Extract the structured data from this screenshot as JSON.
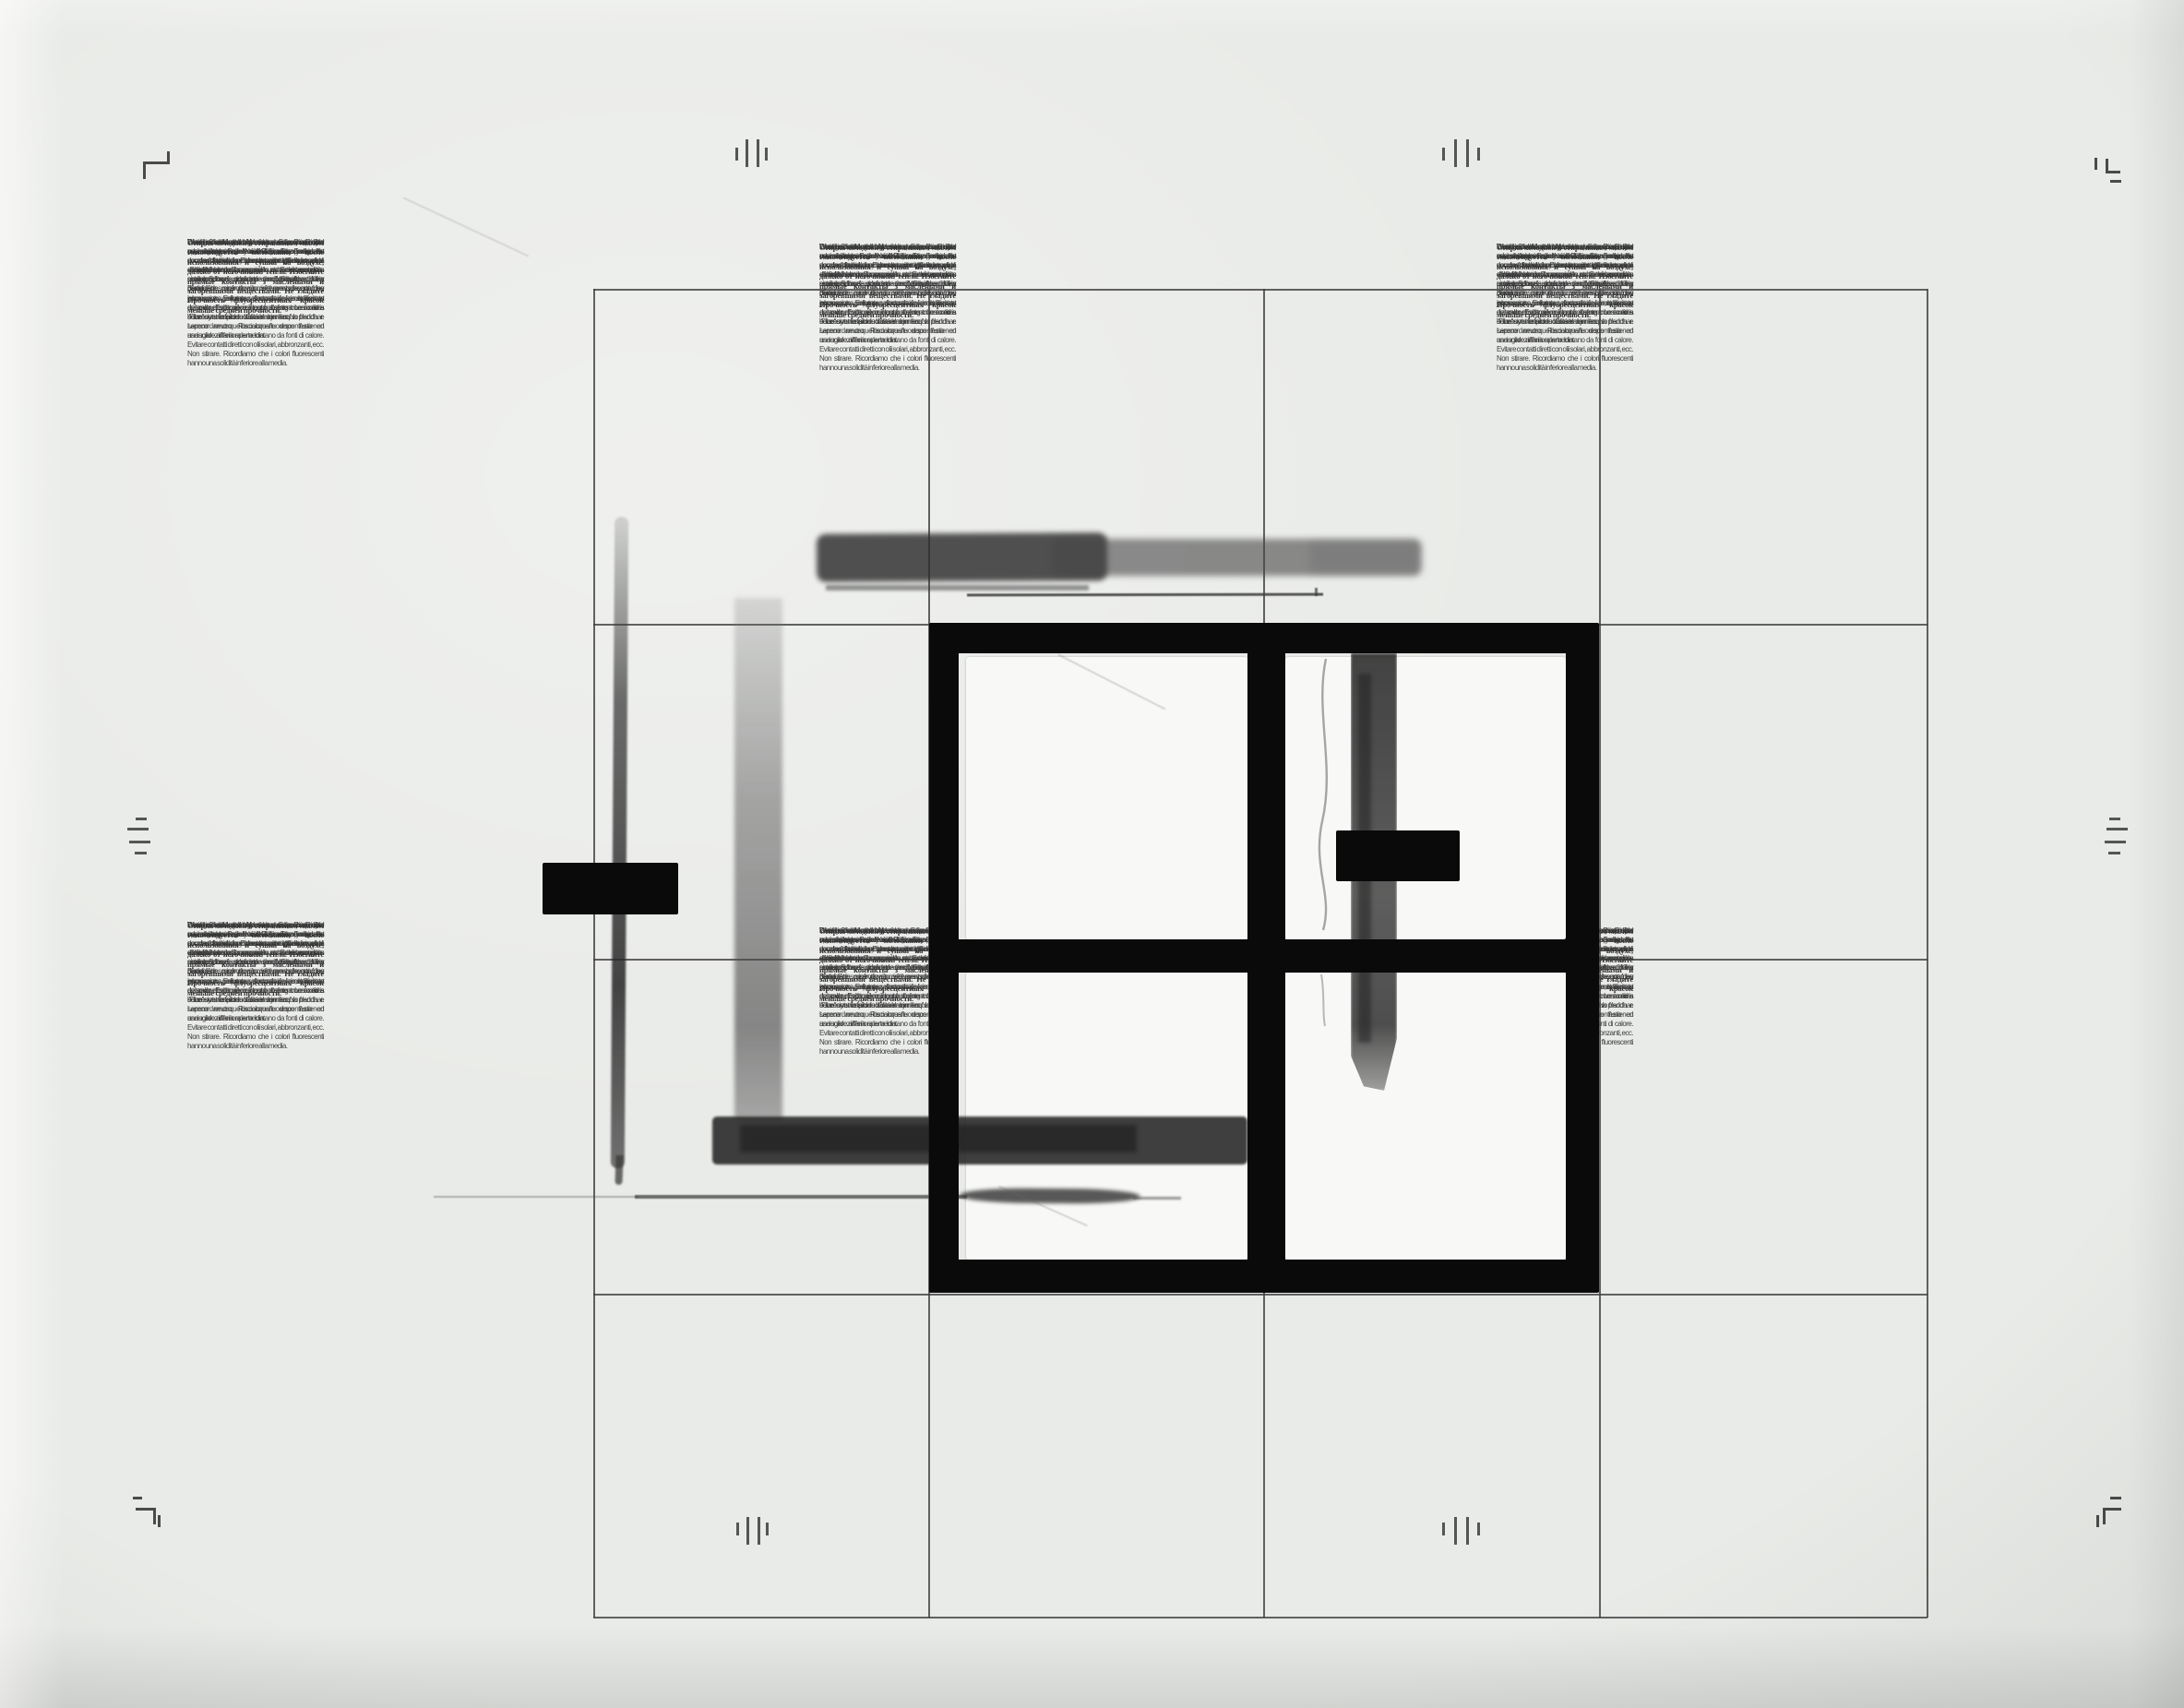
{
  "care_text": {
    "order": [
      "italian",
      "german",
      "english",
      "spanish",
      "french",
      "russian"
    ],
    "italian": "Gentile Cliente, nel ringraziarLa per l'acquisto di un capo della nostra collezione La invitiamo ad usarlo con la stessa cura che usa per gli altri capi di abbigliamento ed a seguire le norme di lavaggio e manutenzione indicate sull'etichetta. Una particolare cura dovrà riservare alle stampe gommose, vellutate, floccate e metallizzate evitando di sottoporre il capo a sfregamento od a eccessive tensioni. Lavare con acqua fredda e sapone neutro. Risciacquare dopo l'uso ed asciugare all'aria aperta lontano da fonti di calore. Evitare contatti diretti con olii solari, abbronzanti, ecc. Non stirare. Ricordiamo che i colori fluorescenti hanno una solidità inferiore alla media.",
    "german": "Waschen mit kaltem Wasser u. Feinwaschmittel oder neutraler Seife. Nach Gebrauch spuelen. An der Luft trocknen lassen von Waermquellen entfernt halten. Sonnenoele und Sonnencremes sowie Sprays schaden dem Gewebe. Kein Buegeln.",
    "english": "Wash in cold water. Use neutral soap. Rinse after use and dry in open air. Keep away From heat sources. Avoid direct contact with tan-cream, sun-oil, etc. No ironing.",
    "spanish": "Distinguido cliente: le agradecemos su compra y le aconsejamos la trate con delicadeza y siga las normas de lavado y manutencion indicadas en la etiqueta. Le rogamos cuide particularmente los estampados de goma, de terciopelo, flocados, y metalizados, sin frotar ni torcer. Lavar con agua fria y jabon neutro. Enjuagar y secar al aire, lejo de fuentes de calor. Evitar el contacto directo con aceites solares y otros productos semejantes. No planchar. Le recordamos que los colores fluorescentes tienen una solidez inferior a la media.",
    "french": "Laver avec de l'eau froide et du savon neutre. Rincer après l'usage et essuyer à l'air libre. Etendre loin des sources de chaleur. Eviter des contacts directs avec des huiles de bronzages et autres produits similaires. Il ne faut pas repasser. Un soin particulier devra être reservé aux vêtements ayant des impressions gommeuses et métalisées, en evitant de soumettre la pièce à tout frottement. Les coloris \"Fluo\" ont une faible solidité à la lumière.",
    "russian": "Стирка холодной в стиральным мылом Рекомендуется полоскание после использования и сушка на воздухе, далеко от источников тепла. Избегайте прямые контакты з маслеными и загоревшими веществами. Не гладите Прочность флуоресцентных красок меньше средней прочности."
  },
  "colors": {
    "sheet": "#e9ebe8",
    "ink": "#3e3e3e",
    "grid_line": "#3d3d3d",
    "paint_black": "#0a0a0a",
    "pane_white": "#f8f9f6"
  }
}
